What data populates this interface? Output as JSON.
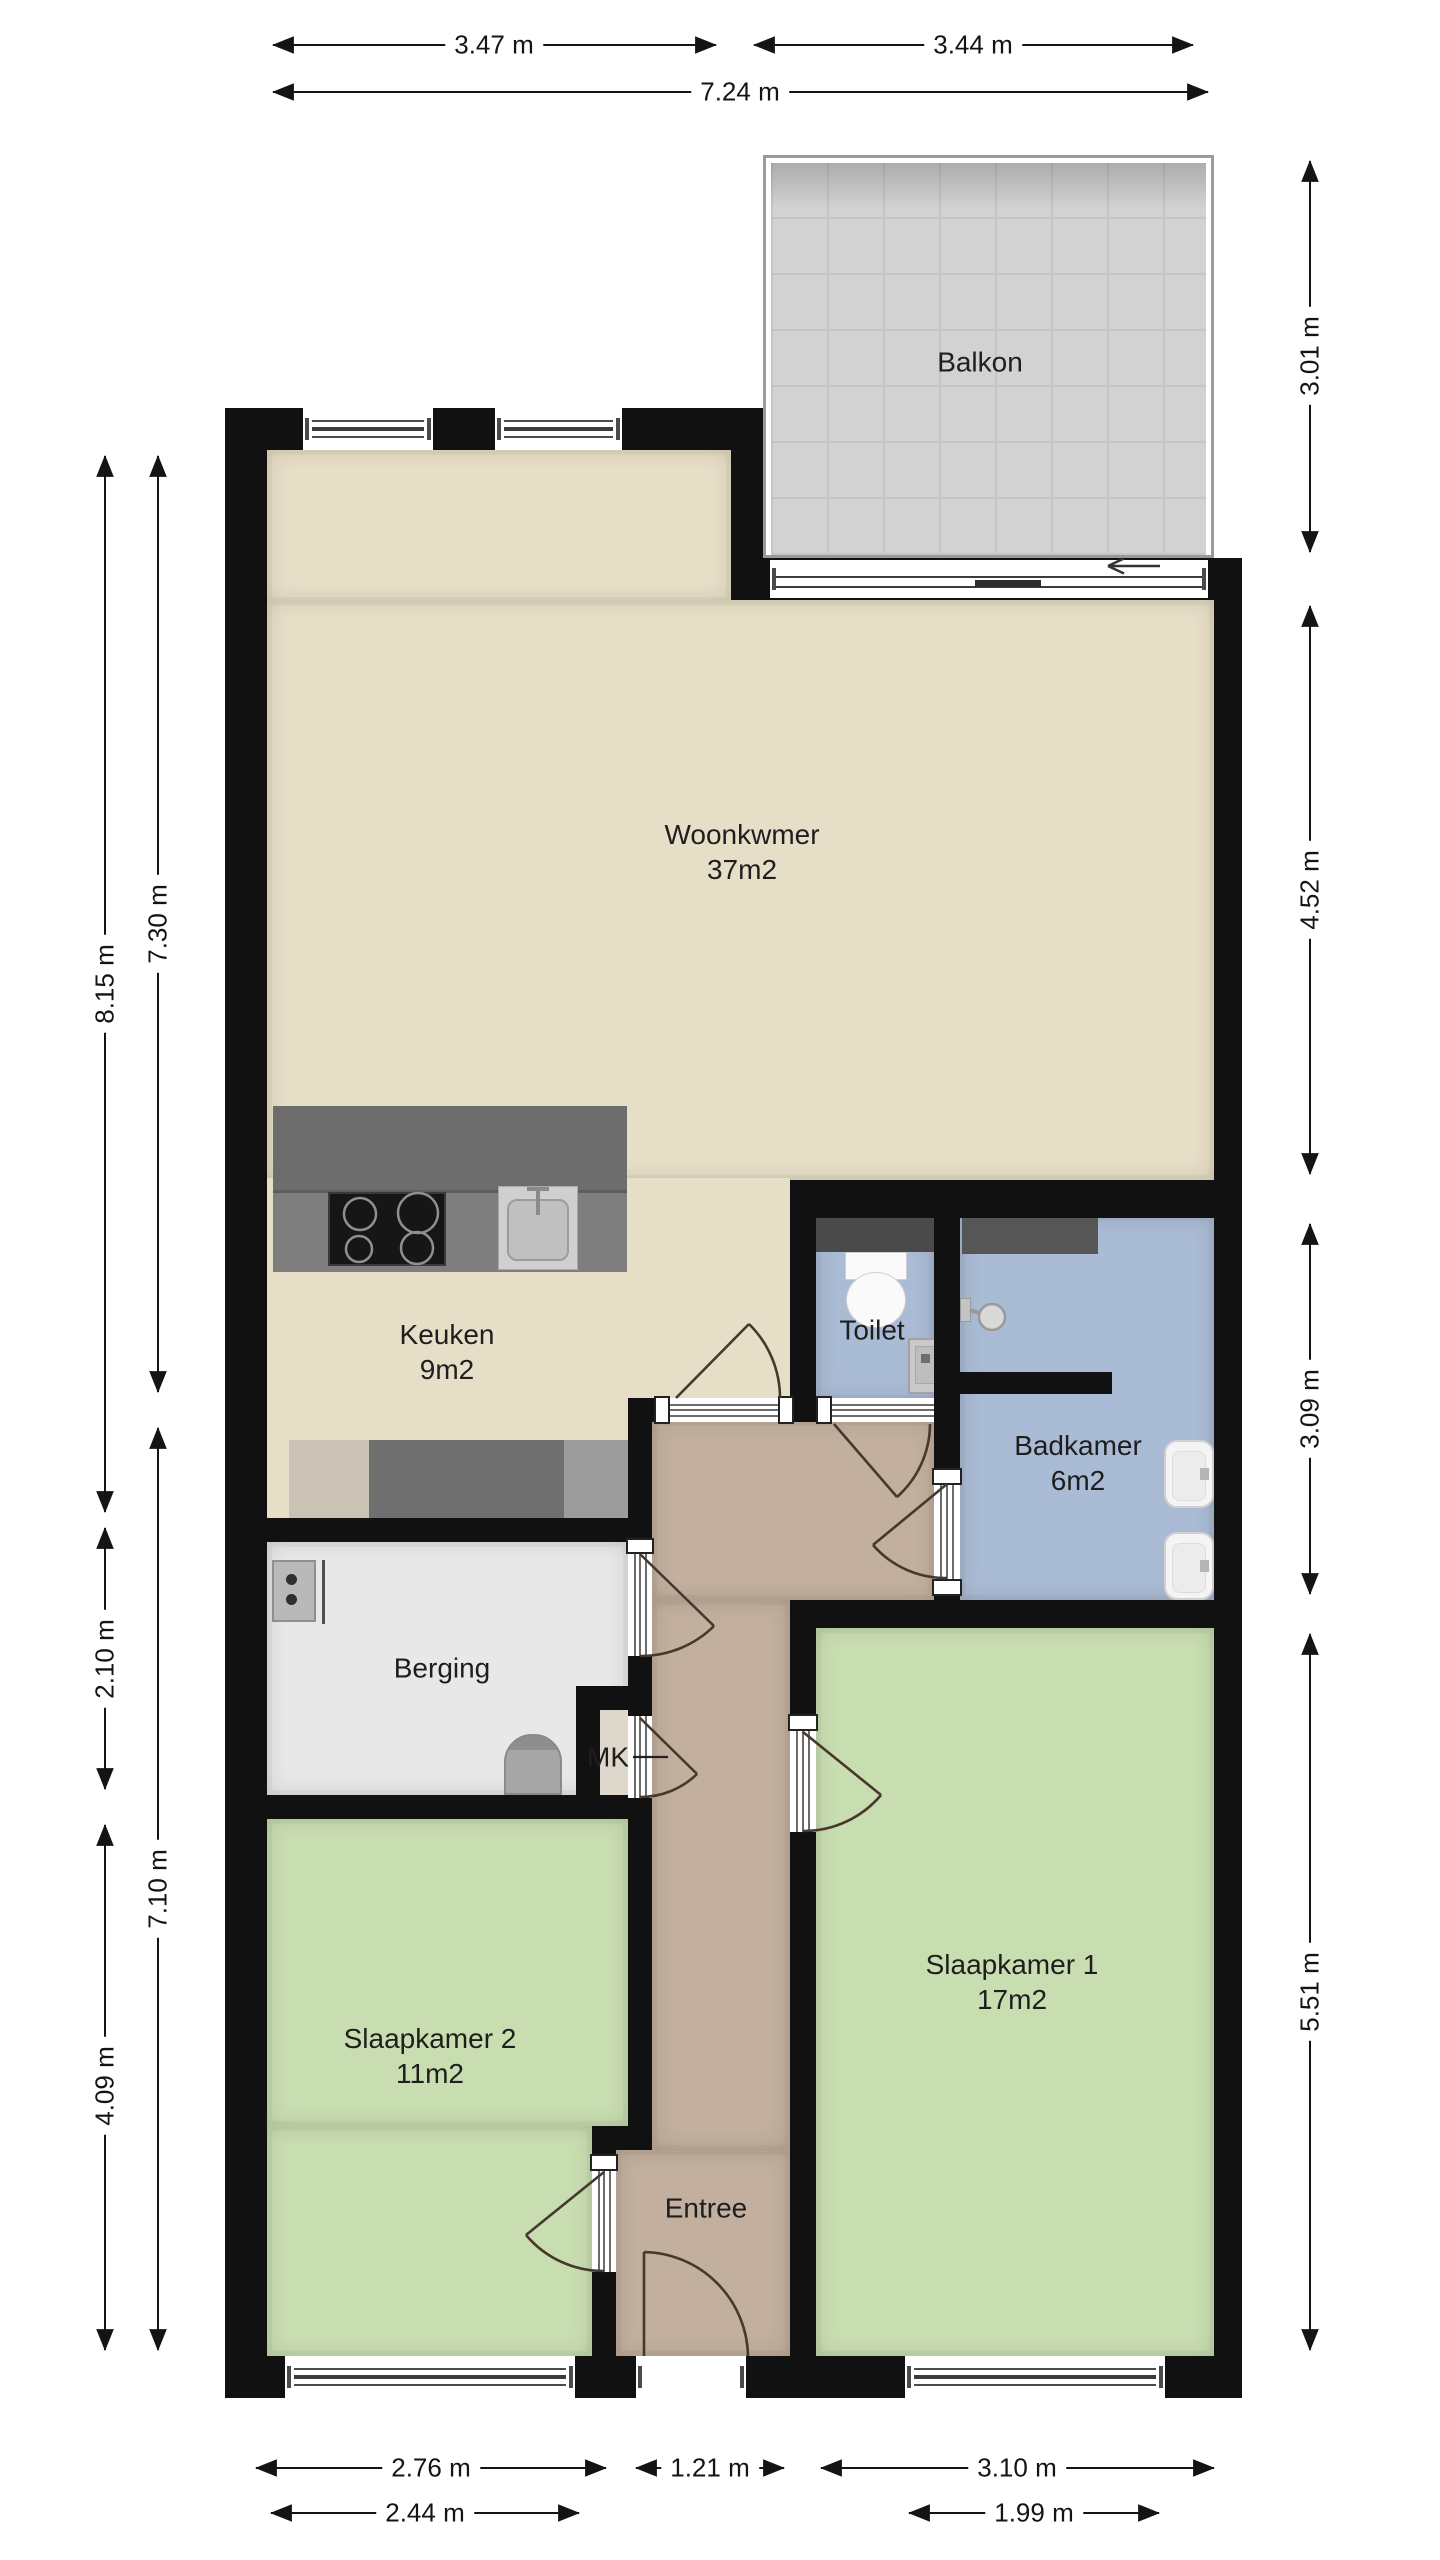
{
  "plan_title": "Apartment floor plan",
  "rooms": {
    "balkon": {
      "name": "Balkon"
    },
    "woonkamer": {
      "name": "Woonkwmer",
      "area": "37m2"
    },
    "keuken": {
      "name": "Keuken",
      "area": "9m2"
    },
    "toilet": {
      "name": "Toilet"
    },
    "badkamer": {
      "name": "Badkamer",
      "area": "6m2"
    },
    "berging": {
      "name": "Berging"
    },
    "mk": {
      "name": "MK"
    },
    "entree": {
      "name": "Entree"
    },
    "slaapkamer1": {
      "name": "Slaapkamer 1",
      "area": "17m2"
    },
    "slaapkamer2": {
      "name": "Slaapkamer 2",
      "area": "11m2"
    }
  },
  "dimensions": {
    "top": [
      "3.47 m",
      "3.44 m",
      "7.24 m"
    ],
    "bottom": [
      "2.76 m",
      "1.21 m",
      "3.10 m",
      "2.44 m",
      "1.99 m"
    ],
    "left": [
      "8.15 m",
      "7.30 m",
      "2.10 m",
      "7.10 m",
      "4.09 m"
    ],
    "right": [
      "3.01 m",
      "4.52 m",
      "3.09 m",
      "5.51 m"
    ]
  },
  "fixtures": [
    "kitchen-island",
    "cooktop",
    "kitchen-sink",
    "counter",
    "toilet-bowl",
    "toilet-basin",
    "shower-head",
    "bathroom-basin",
    "bathroom-basin",
    "washer",
    "boiler",
    "balcony-slide-arrow"
  ],
  "colors": {
    "wall": "#111111",
    "living": "#e6dec7",
    "bedroom": "#c8deb1",
    "bathroom": "#aabbd5",
    "storage": "#e8e8e8",
    "hall": "#c2af9e",
    "balcony": "#d2d2d2",
    "counter_dark": "#6f6f6f",
    "dimension_text": "#141414"
  }
}
